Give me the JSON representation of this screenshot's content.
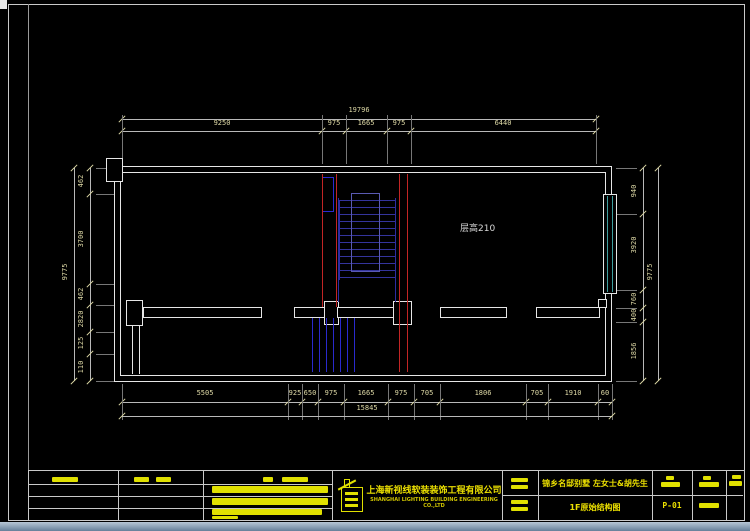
{
  "plan": {
    "room_label": "层高210",
    "colors": {
      "wall": "#e6e6e6",
      "dimension_text": "#ded9a6",
      "red_line": "#c22525",
      "stair_navy": "#2c2ca2",
      "hatch_blue": "#2a2ace",
      "window_cyan": "#3d9e9e",
      "title_yellow": "#e0e000"
    }
  },
  "dims": {
    "h": [
      {
        "y": 119,
        "x1": 122,
        "x2": 596,
        "ticks": [
          122,
          596
        ],
        "ly": 110,
        "labels": [
          {
            "t": "19796",
            "x": 359
          }
        ]
      },
      {
        "y": 131,
        "x1": 122,
        "x2": 596,
        "ticks": [
          122,
          322,
          346,
          387,
          411,
          596
        ],
        "ext": [
          115,
          164
        ],
        "ly": 123,
        "labels": [
          {
            "t": "9250",
            "x": 222
          },
          {
            "t": "975",
            "x": 334
          },
          {
            "t": "1665",
            "x": 366
          },
          {
            "t": "975",
            "x": 399
          },
          {
            "t": "6440",
            "x": 503
          }
        ]
      },
      {
        "y": 402,
        "x1": 122,
        "x2": 612,
        "ticks": [
          122,
          288,
          302,
          318,
          344,
          388,
          414,
          440,
          526,
          548,
          598,
          612
        ],
        "ext": [
          384,
          420
        ],
        "ly": 393,
        "labels": [
          {
            "t": "5505",
            "x": 205
          },
          {
            "t": "925",
            "x": 295
          },
          {
            "t": "650",
            "x": 310
          },
          {
            "t": "975",
            "x": 331
          },
          {
            "t": "1665",
            "x": 366
          },
          {
            "t": "975",
            "x": 401
          },
          {
            "t": "705",
            "x": 427
          },
          {
            "t": "1806",
            "x": 483
          },
          {
            "t": "705",
            "x": 537
          },
          {
            "t": "1910",
            "x": 573
          },
          {
            "t": "60",
            "x": 605
          }
        ]
      },
      {
        "y": 416,
        "x1": 122,
        "x2": 612,
        "ticks": [
          122,
          612
        ],
        "ly": 408,
        "labels": [
          {
            "t": "15845",
            "x": 367
          }
        ]
      }
    ],
    "v": [
      {
        "x": 74,
        "y1": 168,
        "y2": 381,
        "ticks": [
          168,
          381
        ],
        "lx": 65,
        "labels": [
          {
            "t": "9775",
            "y": 272
          }
        ]
      },
      {
        "x": 90,
        "y1": 168,
        "y2": 381,
        "ticks": [
          168,
          194,
          284,
          305,
          332,
          354,
          381
        ],
        "ext": [
          96,
          114
        ],
        "lx": 81,
        "labels": [
          {
            "t": "462",
            "y": 181
          },
          {
            "t": "3700",
            "y": 239
          },
          {
            "t": "462",
            "y": 294
          },
          {
            "t": "2820",
            "y": 319
          },
          {
            "t": "125",
            "y": 343
          },
          {
            "t": "110",
            "y": 367
          }
        ]
      },
      {
        "x": 643,
        "y1": 168,
        "y2": 381,
        "ticks": [
          168,
          214,
          290,
          308,
          322,
          381
        ],
        "ext": [
          616,
          637
        ],
        "lx": 634,
        "labels": [
          {
            "t": "940",
            "y": 191
          },
          {
            "t": "3920",
            "y": 245
          },
          {
            "t": "760",
            "y": 299
          },
          {
            "t": "400",
            "y": 315
          },
          {
            "t": "1856",
            "y": 351
          }
        ]
      },
      {
        "x": 658,
        "y1": 168,
        "y2": 381,
        "ticks": [
          168,
          381
        ],
        "lx": 650,
        "labels": [
          {
            "t": "9775",
            "y": 272
          }
        ]
      }
    ]
  },
  "titleblock": {
    "company_cn": "上海新视线软装装饰工程有限公司",
    "company_en": "SHANGHAI LIGHTING BUILDING ENGINEERING CO.,LTD",
    "project": "锦乡名邸别墅 左女士&胡先生",
    "drawing": "1F原始结构图",
    "sheet_no": "P-01"
  }
}
